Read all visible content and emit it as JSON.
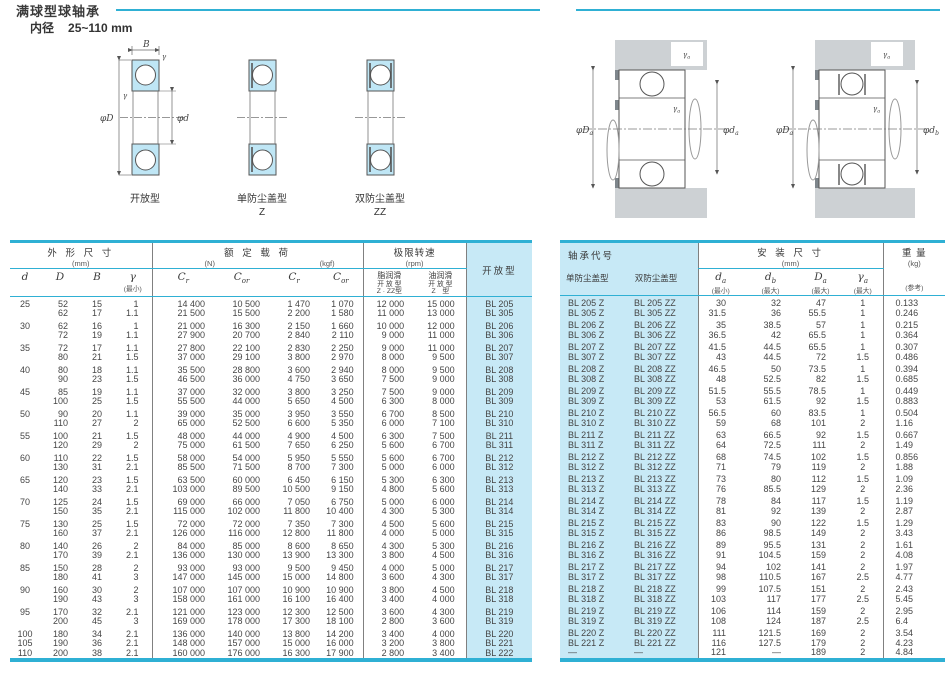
{
  "page": {
    "title": "满球型球轴承",
    "bore_label": "内径",
    "bore_range": "25~110 mm"
  },
  "diagrams": {
    "types": [
      {
        "caption": "开放型",
        "suffix": ""
      },
      {
        "caption": "单防尘盖型",
        "suffix": "Z"
      },
      {
        "caption": "双防尘盖型",
        "suffix": "ZZ"
      }
    ],
    "dims": {
      "B": "B",
      "phiD": "φD",
      "phid": "φd",
      "gamma": "γ"
    },
    "mount1": {
      "D_base": "φD",
      "D_sub": "a",
      "d_base": "φd",
      "d_sub": "a",
      "r_base": "γ",
      "r_sub": "a"
    },
    "mount2": {
      "D_base": "φD",
      "D_sub": "a",
      "d_base": "φd",
      "d_sub": "b",
      "r_base": "γ",
      "r_sub": "a"
    }
  },
  "left_table": {
    "headers": {
      "dim_title": "外 形 尺 寸",
      "dim_unit": "(mm)",
      "col_d": "d",
      "col_D": "D",
      "col_B": "B",
      "col_r": "γ",
      "col_r_note": "(最小)",
      "load_title": "额 定 载 荷",
      "load_unit_n": "(N)",
      "load_unit_kgf": "(kgf)",
      "cr_base": "C",
      "cr_sub": "r",
      "cor_base": "C",
      "cor_sub": "or",
      "speed_title": "极限转速",
      "speed_unit": "(rpm)",
      "grease_name": "脂润滑",
      "grease_line1": "开 放 型",
      "grease_line2": "Z · ZZ型",
      "oil_name": "油润滑",
      "oil_line1": "开 放 型",
      "oil_line2": "Z　型",
      "open_col": "开放型"
    },
    "groups": [
      [
        [
          "25",
          "52",
          "15",
          "1",
          "14 400",
          "10 500",
          "1 470",
          "1 070",
          "12 000",
          "15 000",
          "BL 205"
        ],
        [
          "",
          "62",
          "17",
          "1.1",
          "21 500",
          "15 500",
          "2 200",
          "1 580",
          "11 000",
          "13 000",
          "BL 305"
        ]
      ],
      [
        [
          "30",
          "62",
          "16",
          "1",
          "21 000",
          "16 300",
          "2 150",
          "1 660",
          "10 000",
          "12 000",
          "BL 206"
        ],
        [
          "",
          "72",
          "19",
          "1.1",
          "27 900",
          "20 700",
          "2 840",
          "2 110",
          "9 000",
          "11 000",
          "BL 306"
        ]
      ],
      [
        [
          "35",
          "72",
          "17",
          "1.1",
          "27 800",
          "22 100",
          "2 830",
          "2 250",
          "9 000",
          "11 000",
          "BL 207"
        ],
        [
          "",
          "80",
          "21",
          "1.5",
          "37 000",
          "29 100",
          "3 800",
          "2 970",
          "8 000",
          "9 500",
          "BL 307"
        ]
      ],
      [
        [
          "40",
          "80",
          "18",
          "1.1",
          "35 500",
          "28 800",
          "3 600",
          "2 940",
          "8 000",
          "9 500",
          "BL 208"
        ],
        [
          "",
          "90",
          "23",
          "1.5",
          "46 500",
          "36 000",
          "4 750",
          "3 650",
          "7 500",
          "9 000",
          "BL 308"
        ]
      ],
      [
        [
          "45",
          "85",
          "19",
          "1.1",
          "37 000",
          "32 000",
          "3 800",
          "3 250",
          "7 500",
          "9 000",
          "BL 209"
        ],
        [
          "",
          "100",
          "25",
          "1.5",
          "55 500",
          "44 000",
          "5 650",
          "4 500",
          "6 300",
          "8 000",
          "BL 309"
        ]
      ],
      [
        [
          "50",
          "90",
          "20",
          "1.1",
          "39 000",
          "35 000",
          "3 950",
          "3 550",
          "6 700",
          "8 500",
          "BL 210"
        ],
        [
          "",
          "110",
          "27",
          "2",
          "65 000",
          "52 500",
          "6 600",
          "5 350",
          "6 000",
          "7 100",
          "BL 310"
        ]
      ],
      [
        [
          "55",
          "100",
          "21",
          "1.5",
          "48 000",
          "44 000",
          "4 900",
          "4 500",
          "6 300",
          "7 500",
          "BL 211"
        ],
        [
          "",
          "120",
          "29",
          "2",
          "75 000",
          "61 500",
          "7 650",
          "6 250",
          "5 600",
          "6 700",
          "BL 311"
        ]
      ],
      [
        [
          "60",
          "110",
          "22",
          "1.5",
          "58 000",
          "54 000",
          "5 950",
          "5 550",
          "5 600",
          "6 700",
          "BL 212"
        ],
        [
          "",
          "130",
          "31",
          "2.1",
          "85 500",
          "71 500",
          "8 700",
          "7 300",
          "5 000",
          "6 000",
          "BL 312"
        ]
      ],
      [
        [
          "65",
          "120",
          "23",
          "1.5",
          "63 500",
          "60 000",
          "6 450",
          "6 150",
          "5 300",
          "6 300",
          "BL 213"
        ],
        [
          "",
          "140",
          "33",
          "2.1",
          "103 000",
          "89 500",
          "10 500",
          "9 150",
          "4 800",
          "5 600",
          "BL 313"
        ]
      ],
      [
        [
          "70",
          "125",
          "24",
          "1.5",
          "69 000",
          "66 000",
          "7 050",
          "6 750",
          "5 000",
          "6 000",
          "BL 214"
        ],
        [
          "",
          "150",
          "35",
          "2.1",
          "115 000",
          "102 000",
          "11 800",
          "10 400",
          "4 300",
          "5 300",
          "BL 314"
        ]
      ],
      [
        [
          "75",
          "130",
          "25",
          "1.5",
          "72 000",
          "72 000",
          "7 350",
          "7 300",
          "4 500",
          "5 600",
          "BL 215"
        ],
        [
          "",
          "160",
          "37",
          "2.1",
          "126 000",
          "116 000",
          "12 800",
          "11 800",
          "4 000",
          "5 000",
          "BL 315"
        ]
      ],
      [
        [
          "80",
          "140",
          "26",
          "2",
          "84 000",
          "85 000",
          "8 600",
          "8 650",
          "4 300",
          "5 300",
          "BL 216"
        ],
        [
          "",
          "170",
          "39",
          "2.1",
          "136 000",
          "130 000",
          "13 900",
          "13 300",
          "3 800",
          "4 500",
          "BL 316"
        ]
      ],
      [
        [
          "85",
          "150",
          "28",
          "2",
          "93 000",
          "93 000",
          "9 500",
          "9 450",
          "4 000",
          "5 000",
          "BL 217"
        ],
        [
          "",
          "180",
          "41",
          "3",
          "147 000",
          "145 000",
          "15 000",
          "14 800",
          "3 600",
          "4 300",
          "BL 317"
        ]
      ],
      [
        [
          "90",
          "160",
          "30",
          "2",
          "107 000",
          "107 000",
          "10 900",
          "10 900",
          "3 800",
          "4 500",
          "BL 218"
        ],
        [
          "",
          "190",
          "43",
          "3",
          "158 000",
          "161 000",
          "16 100",
          "16 400",
          "3 400",
          "4 000",
          "BL 318"
        ]
      ],
      [
        [
          "95",
          "170",
          "32",
          "2.1",
          "121 000",
          "123 000",
          "12 300",
          "12 500",
          "3 600",
          "4 300",
          "BL 219"
        ],
        [
          "",
          "200",
          "45",
          "3",
          "169 000",
          "178 000",
          "17 300",
          "18 100",
          "2 800",
          "3 600",
          "BL 319"
        ]
      ],
      [
        [
          "100",
          "180",
          "34",
          "2.1",
          "136 000",
          "140 000",
          "13 800",
          "14 200",
          "3 400",
          "4 000",
          "BL 220"
        ],
        [
          "105",
          "190",
          "36",
          "2.1",
          "148 000",
          "157 000",
          "15 000",
          "16 000",
          "3 200",
          "3 800",
          "BL 221"
        ],
        [
          "110",
          "200",
          "38",
          "2.1",
          "160 000",
          "176 000",
          "16 300",
          "17 900",
          "2 800",
          "3 400",
          "BL 222"
        ]
      ]
    ]
  },
  "right_table": {
    "headers": {
      "code_title": "轴承代号",
      "col_z": "单防尘盖型",
      "col_zz": "双防尘盖型",
      "mount_title": "安 装 尺 寸",
      "mount_unit": "(mm)",
      "da_base": "d",
      "da_sub": "a",
      "da_note": "(最小)",
      "db_base": "d",
      "db_sub": "b",
      "db_note": "(最大)",
      "Da_base": "D",
      "Da_sub": "a",
      "Da_note": "(最大)",
      "ra_base": "γ",
      "ra_sub": "a",
      "ra_note": "(最大)",
      "weight_title": "重 量",
      "weight_unit": "(kg)",
      "weight_note": "(参考)"
    },
    "groups": [
      [
        [
          "BL 205 Z",
          "BL 205 ZZ",
          "30",
          "32",
          "47",
          "1",
          "0.133"
        ],
        [
          "BL 305 Z",
          "BL 305 ZZ",
          "31.5",
          "36",
          "55.5",
          "1",
          "0.246"
        ]
      ],
      [
        [
          "BL 206 Z",
          "BL 206 ZZ",
          "35",
          "38.5",
          "57",
          "1",
          "0.215"
        ],
        [
          "BL 306 Z",
          "BL 306 ZZ",
          "36.5",
          "42",
          "65.5",
          "1",
          "0.364"
        ]
      ],
      [
        [
          "BL 207 Z",
          "BL 207 ZZ",
          "41.5",
          "44.5",
          "65.5",
          "1",
          "0.307"
        ],
        [
          "BL 307 Z",
          "BL 307 ZZ",
          "43",
          "44.5",
          "72",
          "1.5",
          "0.486"
        ]
      ],
      [
        [
          "BL 208 Z",
          "BL 208 ZZ",
          "46.5",
          "50",
          "73.5",
          "1",
          "0.394"
        ],
        [
          "BL 308 Z",
          "BL 308 ZZ",
          "48",
          "52.5",
          "82",
          "1.5",
          "0.685"
        ]
      ],
      [
        [
          "BL 209 Z",
          "BL 209 ZZ",
          "51.5",
          "55.5",
          "78.5",
          "1",
          "0.449"
        ],
        [
          "BL 309 Z",
          "BL 309 ZZ",
          "53",
          "61.5",
          "92",
          "1.5",
          "0.883"
        ]
      ],
      [
        [
          "BL 210 Z",
          "BL 210 ZZ",
          "56.5",
          "60",
          "83.5",
          "1",
          "0.504"
        ],
        [
          "BL 310 Z",
          "BL 310 ZZ",
          "59",
          "68",
          "101",
          "2",
          "1.16"
        ]
      ],
      [
        [
          "BL 211 Z",
          "BL 211 ZZ",
          "63",
          "66.5",
          "92",
          "1.5",
          "0.667"
        ],
        [
          "BL 311 Z",
          "BL 311 ZZ",
          "64",
          "72.5",
          "111",
          "2",
          "1.49"
        ]
      ],
      [
        [
          "BL 212 Z",
          "BL 212 ZZ",
          "68",
          "74.5",
          "102",
          "1.5",
          "0.856"
        ],
        [
          "BL 312 Z",
          "BL 312 ZZ",
          "71",
          "79",
          "119",
          "2",
          "1.88"
        ]
      ],
      [
        [
          "BL 213 Z",
          "BL 213 ZZ",
          "73",
          "80",
          "112",
          "1.5",
          "1.09"
        ],
        [
          "BL 313 Z",
          "BL 313 ZZ",
          "76",
          "85.5",
          "129",
          "2",
          "2.36"
        ]
      ],
      [
        [
          "BL 214 Z",
          "BL 214 ZZ",
          "78",
          "84",
          "117",
          "1.5",
          "1.19"
        ],
        [
          "BL 314 Z",
          "BL 314 ZZ",
          "81",
          "92",
          "139",
          "2",
          "2.87"
        ]
      ],
      [
        [
          "BL 215 Z",
          "BL 215 ZZ",
          "83",
          "90",
          "122",
          "1.5",
          "1.29"
        ],
        [
          "BL 315 Z",
          "BL 315 ZZ",
          "86",
          "98.5",
          "149",
          "2",
          "3.43"
        ]
      ],
      [
        [
          "BL 216 Z",
          "BL 216 ZZ",
          "89",
          "95.5",
          "131",
          "2",
          "1.61"
        ],
        [
          "BL 316 Z",
          "BL 316 ZZ",
          "91",
          "104.5",
          "159",
          "2",
          "4.08"
        ]
      ],
      [
        [
          "BL 217 Z",
          "BL 217 ZZ",
          "94",
          "102",
          "141",
          "2",
          "1.97"
        ],
        [
          "BL 317 Z",
          "BL 317 ZZ",
          "98",
          "110.5",
          "167",
          "2.5",
          "4.77"
        ]
      ],
      [
        [
          "BL 218 Z",
          "BL 218 ZZ",
          "99",
          "107.5",
          "151",
          "2",
          "2.43"
        ],
        [
          "BL 318 Z",
          "BL 318 ZZ",
          "103",
          "117",
          "177",
          "2.5",
          "5.45"
        ]
      ],
      [
        [
          "BL 219 Z",
          "BL 219 ZZ",
          "106",
          "114",
          "159",
          "2",
          "2.95"
        ],
        [
          "BL 319 Z",
          "BL 319 ZZ",
          "108",
          "124",
          "187",
          "2.5",
          "6.4"
        ]
      ],
      [
        [
          "BL 220 Z",
          "BL 220 ZZ",
          "111",
          "121.5",
          "169",
          "2",
          "3.54"
        ],
        [
          "BL 221 Z",
          "BL 221 ZZ",
          "116",
          "127.5",
          "179",
          "2",
          "4.23"
        ],
        [
          "—",
          "—",
          "121",
          "—",
          "189",
          "2",
          "4.84"
        ]
      ]
    ]
  }
}
